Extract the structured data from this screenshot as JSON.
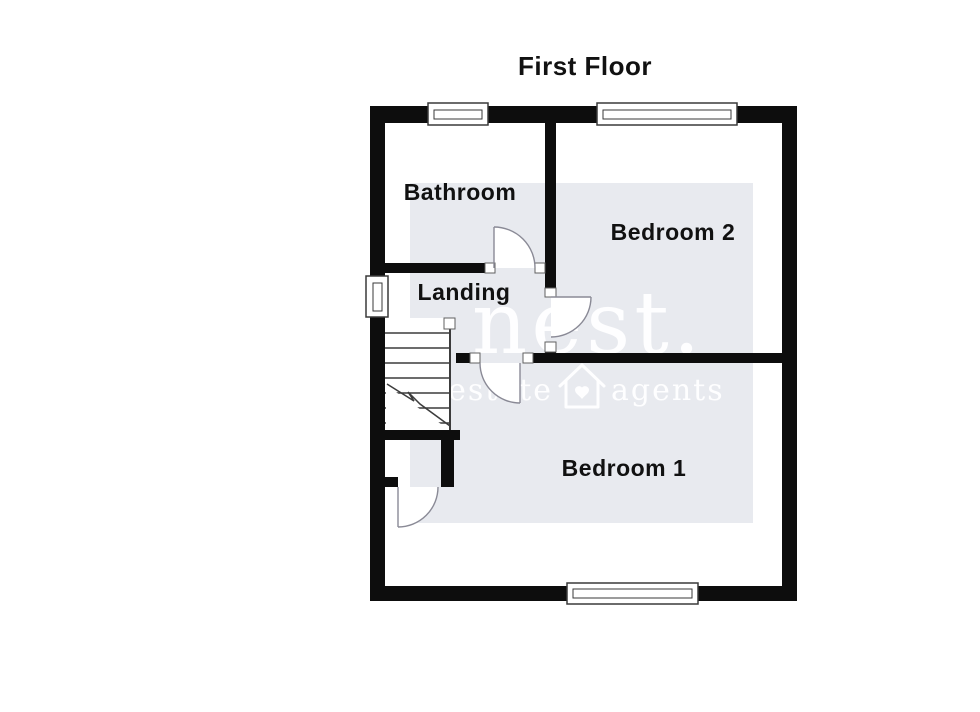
{
  "title": "First Floor",
  "rooms": {
    "bathroom": {
      "label": "Bathroom"
    },
    "bedroom2": {
      "label": "Bedroom 2"
    },
    "landing": {
      "label": "Landing"
    },
    "bedroom1": {
      "label": "Bedroom 1"
    }
  },
  "watermark": {
    "brand": "nest.",
    "tagline_left": "estate",
    "tagline_right": "agents",
    "icon": "house-heart-icon",
    "bg_color": "#e8eaef",
    "text_color": "#ffffff"
  },
  "colors": {
    "wall": "#0d0d0d",
    "door_arc": "#8a8a96",
    "label_text": "#111111",
    "background": "#ffffff"
  }
}
